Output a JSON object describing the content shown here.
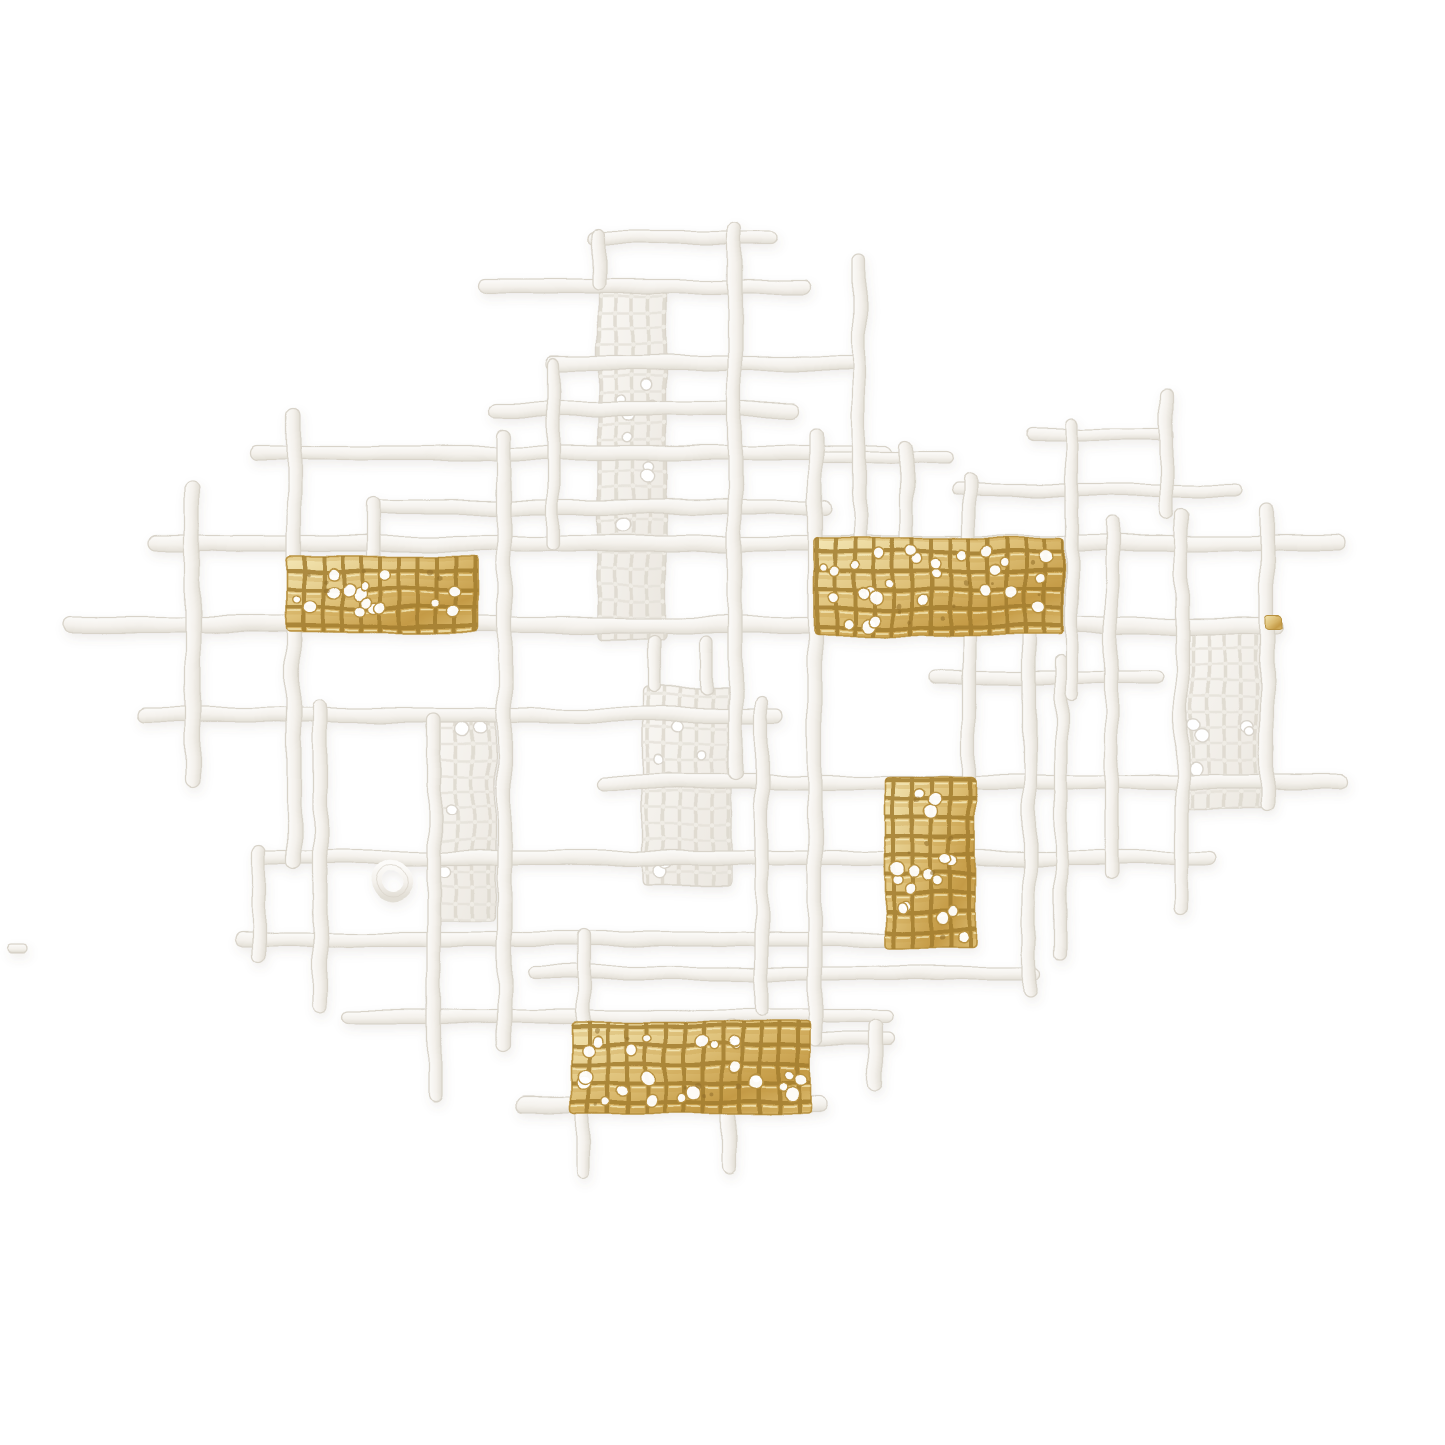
{
  "canvas": {
    "width": 1445,
    "height": 1445,
    "background": "#ffffff"
  },
  "palette": {
    "background": "#ffffff",
    "plaster_light": "#fcfbf9",
    "plaster_mid": "#f4f1ec",
    "plaster_dark": "#e2ded5",
    "plaster_stroke": "#d8d3c9",
    "mesh_line_v": "#ddd8ce",
    "mesh_line_h": "#e6e2da",
    "gold_light": "#f4e7b5",
    "gold_mid": "#ddbe74",
    "gold_deep": "#c49a45",
    "gold_line": "#a27d2e",
    "gold_speck": "#8f6d2a",
    "hole_fill": "#ffffff",
    "hole_stroke_white": "#d9d4cb",
    "hole_stroke_gold": "#b8913f",
    "shadow": "rgba(120,110,95,0.10)"
  },
  "texture_seed": 7,
  "artwork": {
    "bars_horizontal": [
      {
        "x": 588,
        "y": 231,
        "w": 190,
        "h": 13
      },
      {
        "x": 478,
        "y": 279,
        "w": 334,
        "h": 14
      },
      {
        "x": 545,
        "y": 356,
        "w": 317,
        "h": 14
      },
      {
        "x": 490,
        "y": 402,
        "w": 307,
        "h": 14
      },
      {
        "x": 250,
        "y": 446,
        "w": 643,
        "h": 14
      },
      {
        "x": 813,
        "y": 452,
        "w": 140,
        "h": 12
      },
      {
        "x": 1026,
        "y": 428,
        "w": 148,
        "h": 12
      },
      {
        "x": 367,
        "y": 500,
        "w": 464,
        "h": 14
      },
      {
        "x": 950,
        "y": 484,
        "w": 292,
        "h": 12
      },
      {
        "x": 148,
        "y": 536,
        "w": 1199,
        "h": 15
      },
      {
        "x": 63,
        "y": 617,
        "w": 1220,
        "h": 16
      },
      {
        "x": 930,
        "y": 671,
        "w": 232,
        "h": 13
      },
      {
        "x": 138,
        "y": 708,
        "w": 646,
        "h": 14
      },
      {
        "x": 595,
        "y": 775,
        "w": 752,
        "h": 14
      },
      {
        "x": 253,
        "y": 851,
        "w": 964,
        "h": 14
      },
      {
        "x": 235,
        "y": 932,
        "w": 682,
        "h": 14
      },
      {
        "x": 527,
        "y": 967,
        "w": 513,
        "h": 13
      },
      {
        "x": 342,
        "y": 1010,
        "w": 551,
        "h": 13
      },
      {
        "x": 810,
        "y": 1033,
        "w": 85,
        "h": 12
      },
      {
        "x": 517,
        "y": 1097,
        "w": 310,
        "h": 15
      },
      {
        "x": 8,
        "y": 945,
        "w": 20,
        "h": 8
      }
    ],
    "bars_vertical": [
      {
        "x": 592,
        "y": 228,
        "w": 13,
        "h": 62
      },
      {
        "x": 728,
        "y": 221,
        "w": 14,
        "h": 560
      },
      {
        "x": 853,
        "y": 253,
        "w": 13,
        "h": 344
      },
      {
        "x": 900,
        "y": 440,
        "w": 13,
        "h": 180
      },
      {
        "x": 497,
        "y": 428,
        "w": 14,
        "h": 625
      },
      {
        "x": 287,
        "y": 408,
        "w": 14,
        "h": 462
      },
      {
        "x": 313,
        "y": 700,
        "w": 14,
        "h": 313
      },
      {
        "x": 185,
        "y": 480,
        "w": 15,
        "h": 308
      },
      {
        "x": 253,
        "y": 845,
        "w": 13,
        "h": 118
      },
      {
        "x": 428,
        "y": 713,
        "w": 13,
        "h": 390
      },
      {
        "x": 577,
        "y": 930,
        "w": 13,
        "h": 248
      },
      {
        "x": 722,
        "y": 1020,
        "w": 14,
        "h": 155
      },
      {
        "x": 869,
        "y": 1020,
        "w": 14,
        "h": 70
      },
      {
        "x": 808,
        "y": 428,
        "w": 14,
        "h": 617
      },
      {
        "x": 962,
        "y": 475,
        "w": 13,
        "h": 412
      },
      {
        "x": 1023,
        "y": 630,
        "w": 13,
        "h": 367
      },
      {
        "x": 1055,
        "y": 655,
        "w": 12,
        "h": 305
      },
      {
        "x": 1105,
        "y": 517,
        "w": 13,
        "h": 363
      },
      {
        "x": 1175,
        "y": 508,
        "w": 13,
        "h": 405
      },
      {
        "x": 1260,
        "y": 505,
        "w": 14,
        "h": 305
      },
      {
        "x": 1160,
        "y": 390,
        "w": 13,
        "h": 130
      },
      {
        "x": 1066,
        "y": 418,
        "w": 12,
        "h": 282
      },
      {
        "x": 547,
        "y": 358,
        "w": 12,
        "h": 192
      },
      {
        "x": 367,
        "y": 497,
        "w": 13,
        "h": 130
      },
      {
        "x": 755,
        "y": 697,
        "w": 13,
        "h": 320
      },
      {
        "x": 648,
        "y": 636,
        "w": 12,
        "h": 58
      },
      {
        "x": 700,
        "y": 636,
        "w": 12,
        "h": 58
      }
    ],
    "mesh_panels": [
      {
        "x": 598,
        "y": 280,
        "w": 68,
        "h": 360
      },
      {
        "x": 643,
        "y": 688,
        "w": 88,
        "h": 197
      },
      {
        "x": 433,
        "y": 713,
        "w": 62,
        "h": 208
      },
      {
        "x": 1183,
        "y": 622,
        "w": 88,
        "h": 185
      }
    ],
    "gold_panels": [
      {
        "x": 287,
        "y": 556,
        "w": 191,
        "h": 77
      },
      {
        "x": 814,
        "y": 538,
        "w": 250,
        "h": 97
      },
      {
        "x": 885,
        "y": 776,
        "w": 90,
        "h": 172
      },
      {
        "x": 572,
        "y": 1022,
        "w": 238,
        "h": 91
      }
    ],
    "gold_fleck": {
      "x": 1266,
      "y": 615,
      "w": 16,
      "h": 13
    },
    "ring": {
      "cx": 393,
      "cy": 881,
      "r": 16,
      "stroke_w": 10
    }
  }
}
